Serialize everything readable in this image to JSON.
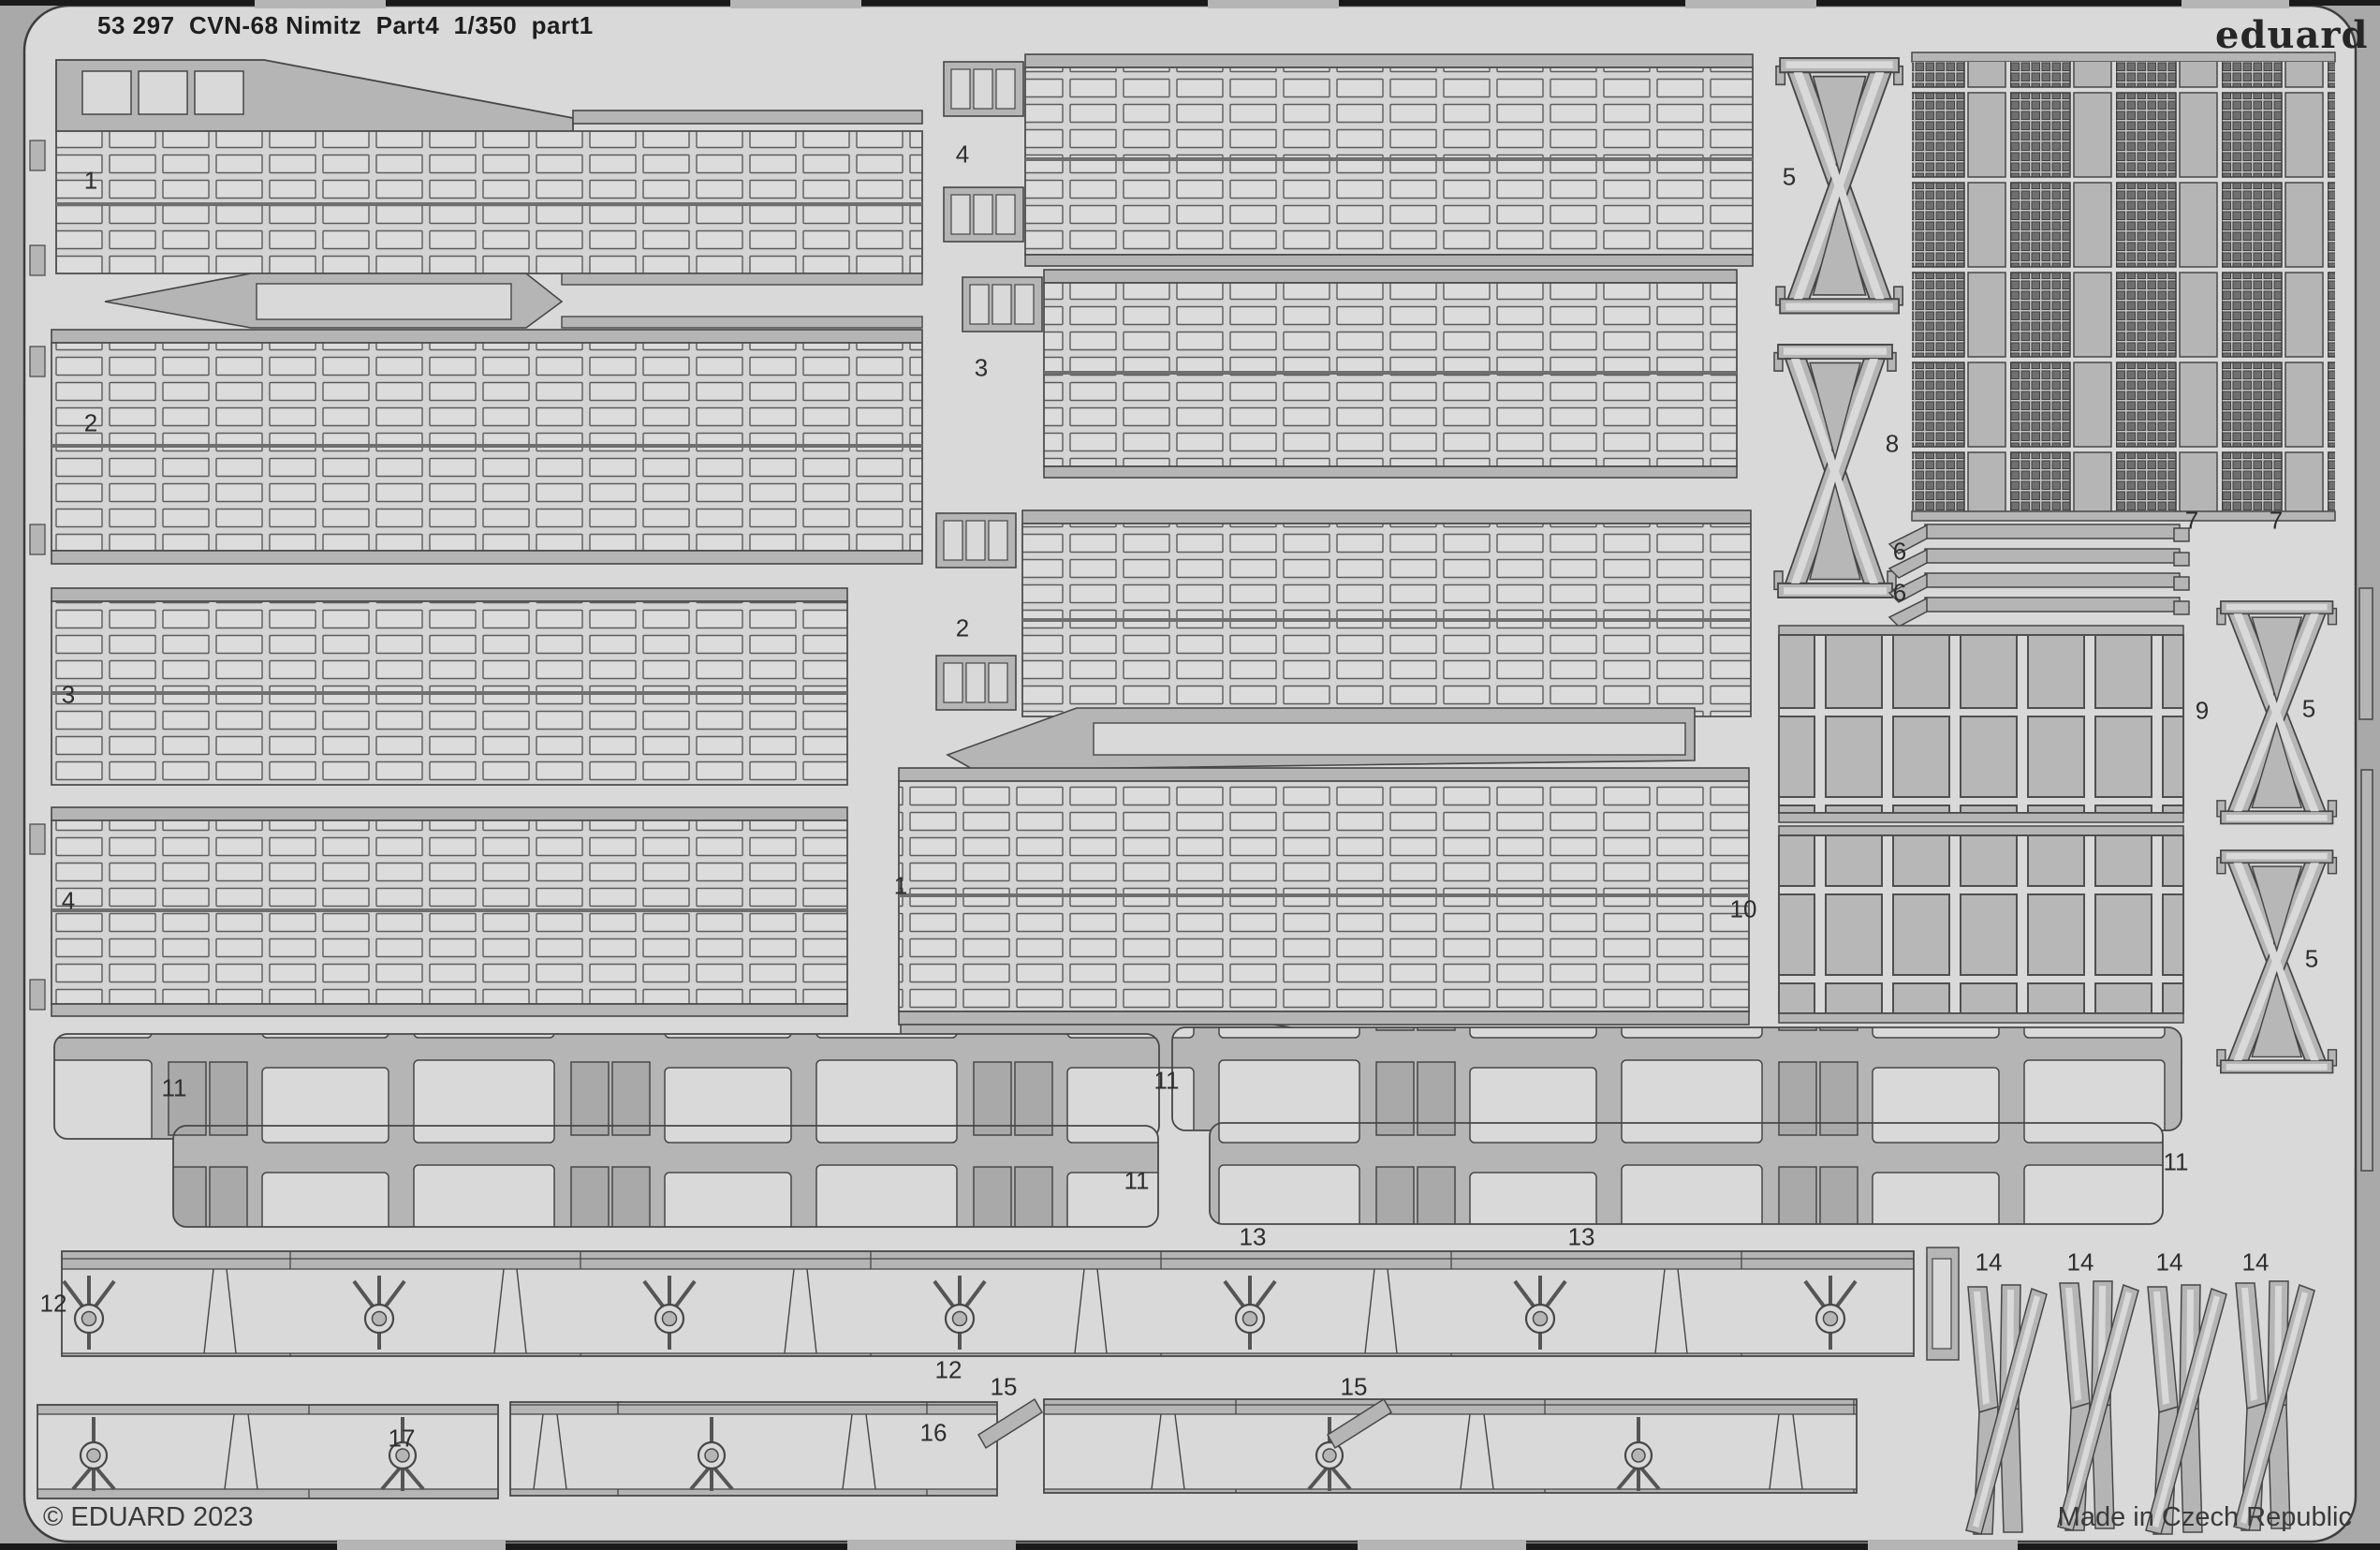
{
  "header": {
    "title": "53 297  CVN-68 Nimitz  Part4  1/350  part1"
  },
  "brand": {
    "logo_text": "eduard"
  },
  "footer": {
    "copyright": "© EDUARD 2023",
    "made_in": "Made in Czech Republic"
  },
  "colors": {
    "sheet": "#d9d9d9",
    "fret_metal": "#b5b5b5",
    "outline": "#474747",
    "margin": "#a9a9a9",
    "edge_black": "#1a1a1a",
    "mesh_dark": "#6f6f6f",
    "big_cell": "#b7b7b7",
    "text": "#2e2e2e"
  },
  "part_labels": [
    {
      "text": "1"
    },
    {
      "text": "2"
    },
    {
      "text": "3"
    },
    {
      "text": "4"
    },
    {
      "text": "4"
    },
    {
      "text": "3"
    },
    {
      "text": "2"
    },
    {
      "text": "1"
    },
    {
      "text": "5"
    },
    {
      "text": "8"
    },
    {
      "text": "7"
    },
    {
      "text": "7"
    },
    {
      "text": "6"
    },
    {
      "text": "6"
    },
    {
      "text": "9"
    },
    {
      "text": "5"
    },
    {
      "text": "10"
    },
    {
      "text": "5"
    },
    {
      "text": "11"
    },
    {
      "text": "11"
    },
    {
      "text": "11"
    },
    {
      "text": "11"
    },
    {
      "text": "13"
    },
    {
      "text": "13"
    },
    {
      "text": "12"
    },
    {
      "text": "12"
    },
    {
      "text": "15"
    },
    {
      "text": "15"
    },
    {
      "text": "16"
    },
    {
      "text": "17"
    },
    {
      "text": "14"
    },
    {
      "text": "14"
    },
    {
      "text": "14"
    },
    {
      "text": "14"
    }
  ]
}
